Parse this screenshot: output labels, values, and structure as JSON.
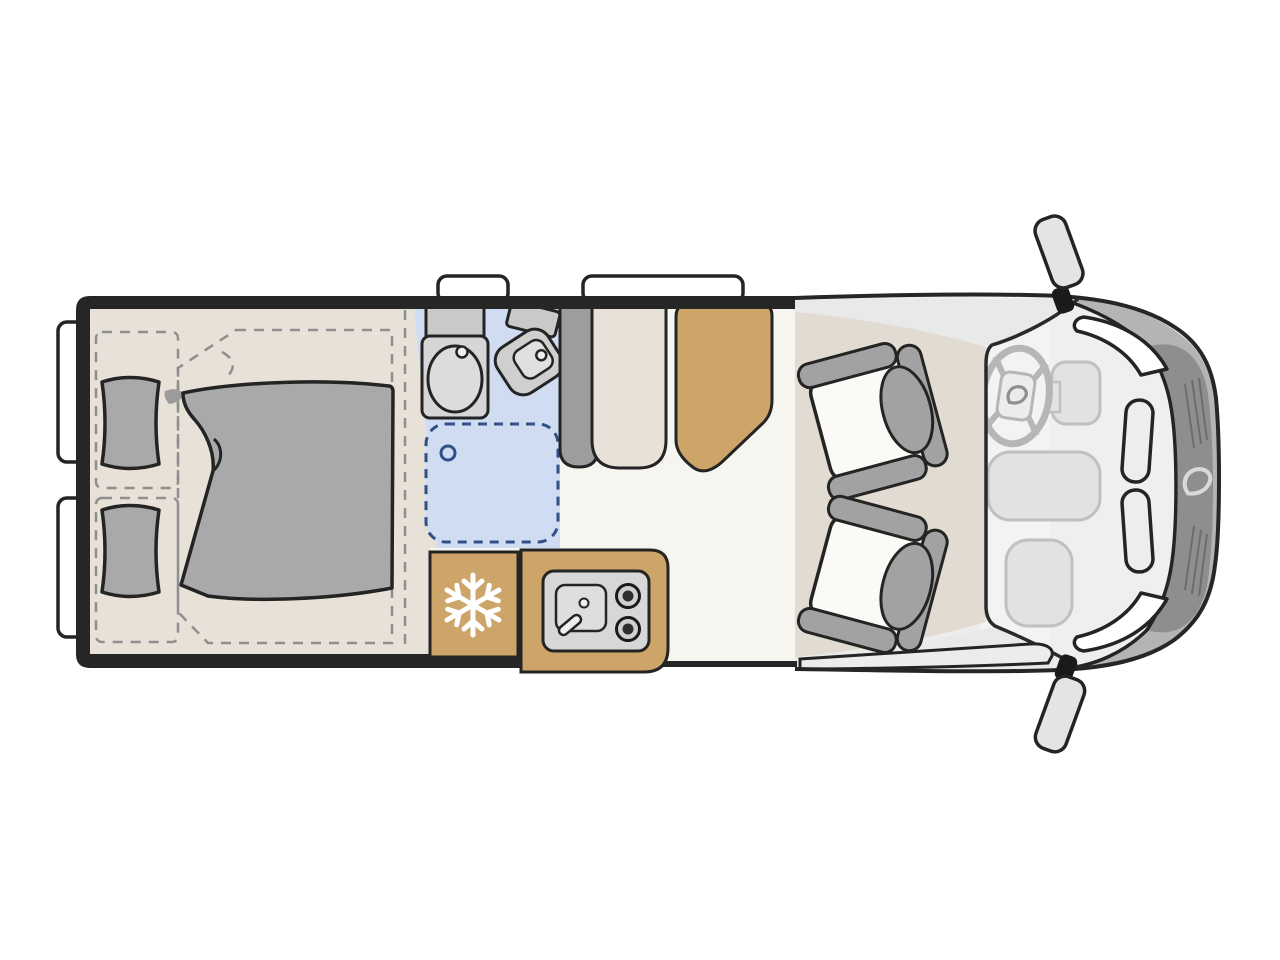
{
  "page": {
    "title": "Camper van floor plan (top view)",
    "description": "Top-down floor plan of a camper van: rear double bed with two pillows and duvet, bathroom with sink, toilet and shower, wardrobe, dinette bench with table, kitchen block with refrigerator (snowflake), sink and two-burner hob, and a driver cab with two swivelled seats, steering wheel, headlights and side mirrors."
  },
  "palette": {
    "background": "#ffffff",
    "wall_black": "#262626",
    "outline_dark": "#242424",
    "floor_white": "#f7f5f0",
    "bed_area_beige": "#e7e1d7",
    "cab_floor_beige": "#e1dbd1",
    "bathroom_blue": "#cfdcf1",
    "shower_dash_blue": "#31508a",
    "kitchen_tan": "#cda569",
    "upholstery_gray": "#a9a9a9",
    "furniture_gray": "#9d9d9d",
    "fixture_gray": "#d6d6d6",
    "van_body_gray": "#ededed",
    "body_band_gray": "#e9e9e9",
    "glass_gray": "#f3f3f3",
    "bumper_gray": "#b4b4b4",
    "grille_gray": "#8e8e8e",
    "seat_white": "#fbfaf7",
    "window_white": "#ffffff",
    "snowflake_white": "#ffffff",
    "dash_line_gray": "#8f8f8f"
  },
  "floorplan": {
    "zones": [
      {
        "name": "rear-double-bed"
      },
      {
        "name": "bathroom-with-shower"
      },
      {
        "name": "wardrobe"
      },
      {
        "name": "dinette-bench-and-table"
      },
      {
        "name": "kitchen-block"
      },
      {
        "name": "driver-cab"
      }
    ],
    "fixtures": [
      {
        "icon": "snowflake-icon",
        "meaning": "refrigerator"
      },
      {
        "icon": "two-burner-hob-icon",
        "meaning": "gas cooker"
      },
      {
        "icon": "kitchen-sink-icon",
        "meaning": "kitchen sink with faucet"
      },
      {
        "icon": "washbasin-icon",
        "meaning": "bathroom sink"
      },
      {
        "icon": "toilet-icon",
        "meaning": "swivel toilet"
      },
      {
        "icon": "shower-icon",
        "meaning": "shower tray (dashed)"
      },
      {
        "icon": "steering-wheel-icon",
        "meaning": "driver position"
      },
      {
        "icon": "swivel-seat-icon",
        "meaning": "rotating cab seat",
        "count": 2
      },
      {
        "icon": "side-mirror-icon",
        "meaning": "exterior mirror",
        "count": 2
      },
      {
        "icon": "brand-swoosh-icon",
        "meaning": "manufacturer logo",
        "count": 2
      }
    ]
  }
}
